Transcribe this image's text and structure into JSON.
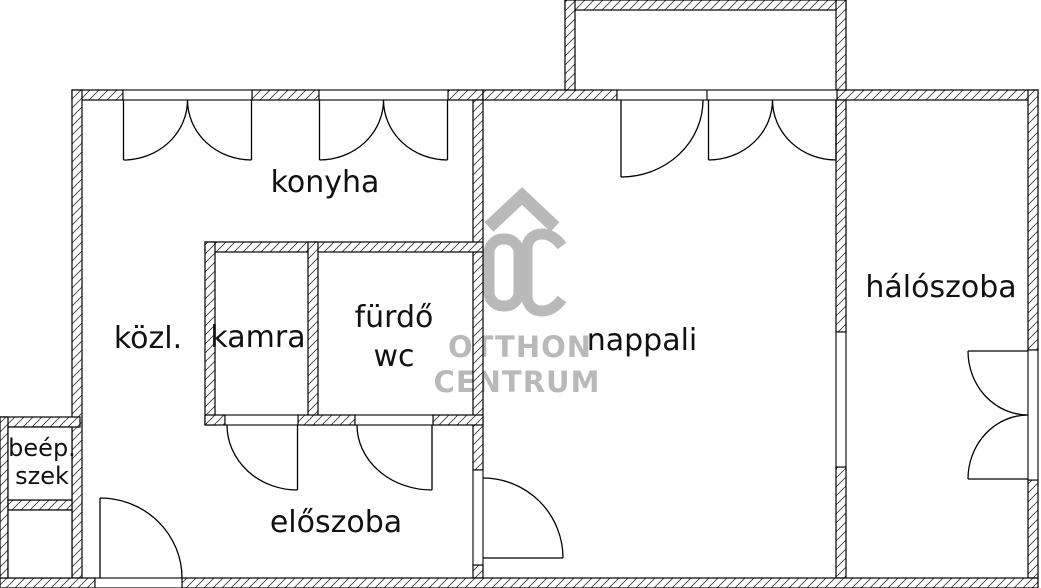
{
  "document": {
    "type": "apartment-floor-plan"
  },
  "rooms": {
    "konyha": "konyha",
    "kozl": "közl.",
    "kamra": "kamra",
    "furdo": "fürdő",
    "wc": "wc",
    "nappali": "nappali",
    "haloszoba": "hálószoba",
    "eloszoba": "előszoba",
    "beep_line1": "beép.",
    "beep_line2": "szek"
  },
  "watermark": {
    "brand_top": "OTTHON",
    "brand_bottom": "CENTRUM",
    "logo": "oc-roof-monogram",
    "color": "#b9b9b9"
  },
  "colors": {
    "background": "#ffffff",
    "wall_line": "#000000",
    "hatch": "#3c3c3c",
    "label": "#111111"
  }
}
